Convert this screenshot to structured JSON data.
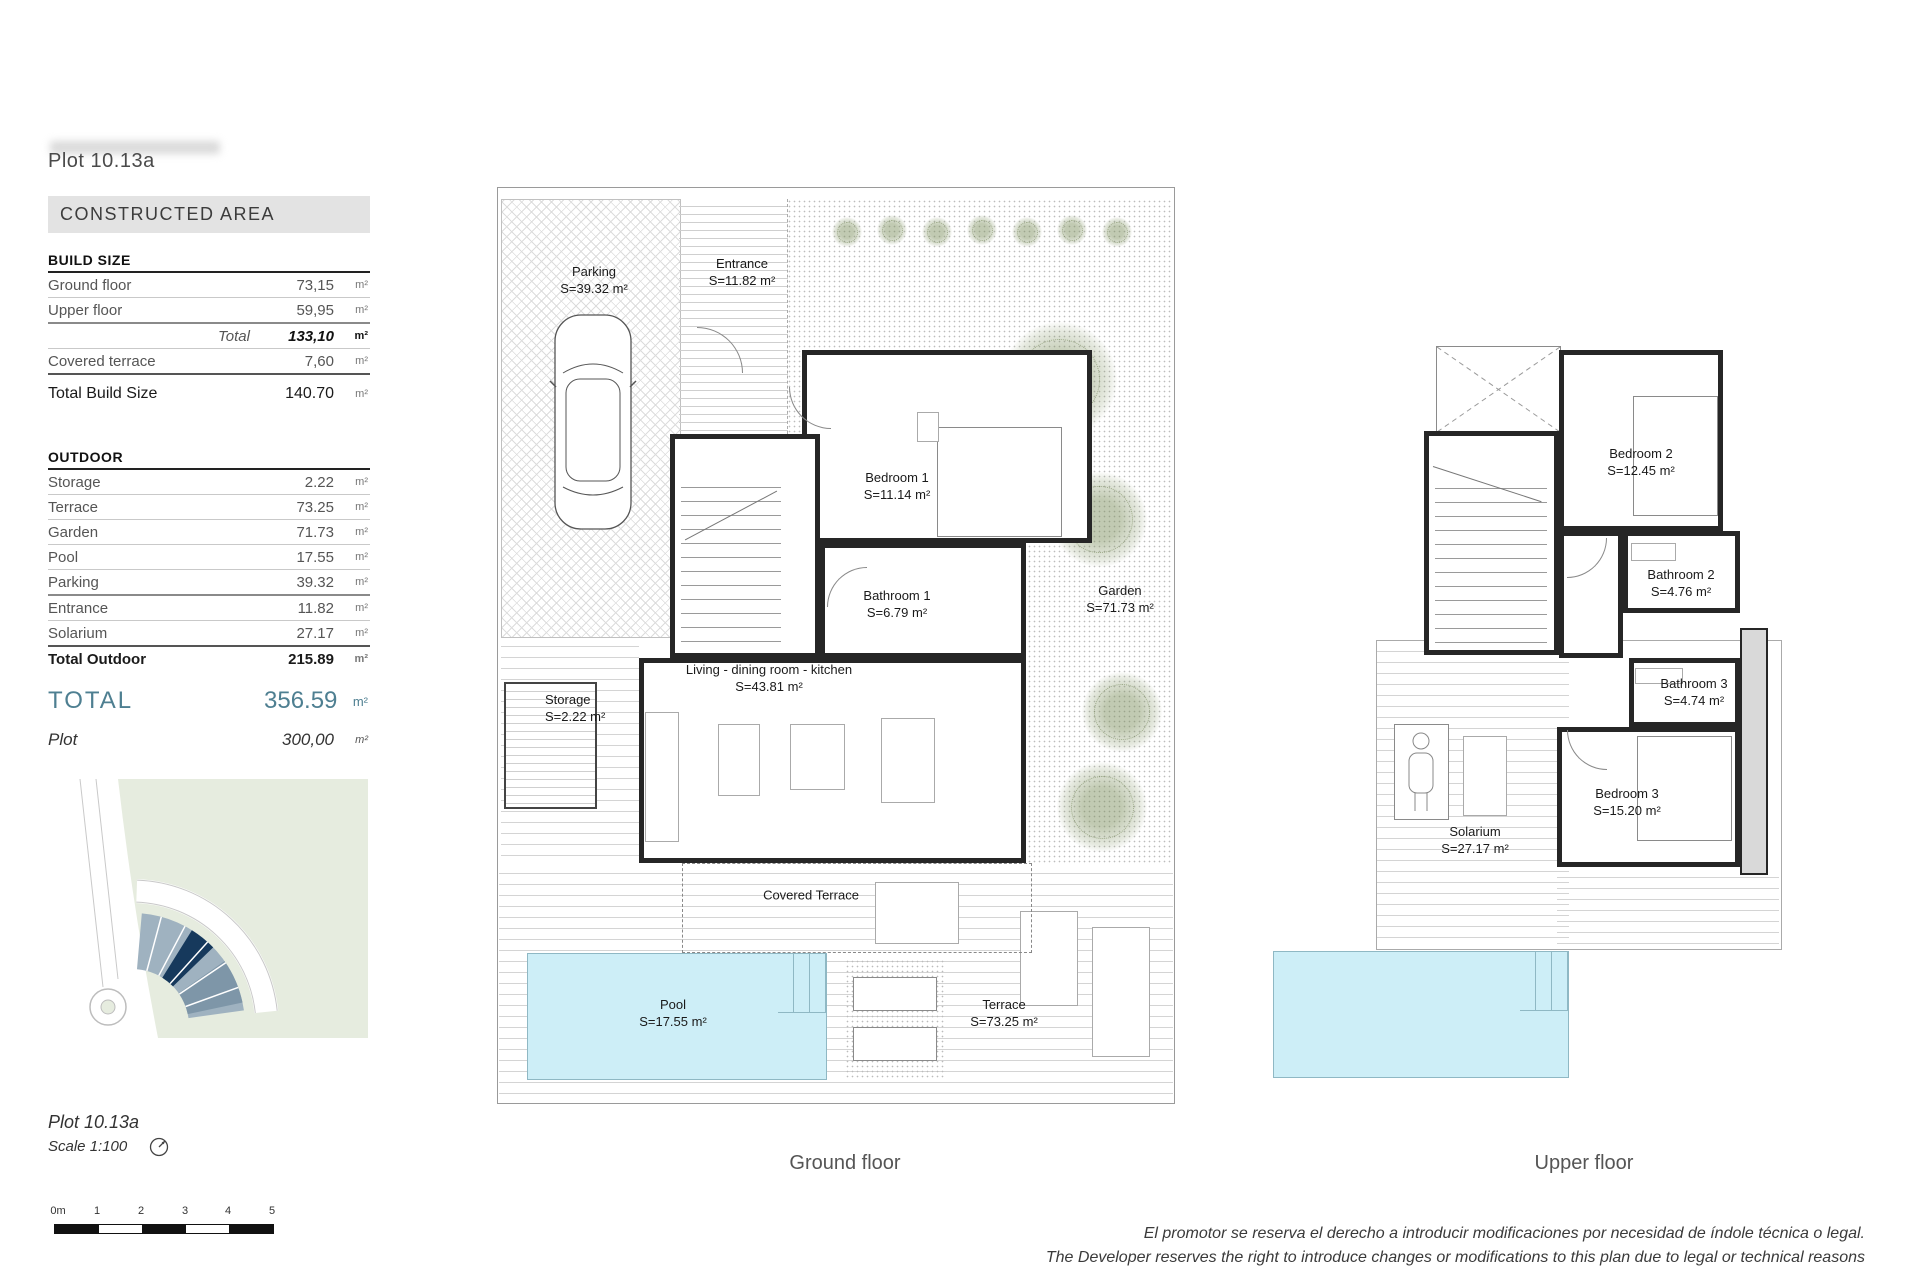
{
  "header": {
    "plot_title": "Plot 10.13a",
    "section_header": "CONSTRUCTED AREA"
  },
  "build_size": {
    "header": "BUILD SIZE",
    "rows": [
      {
        "label": "Ground floor",
        "value": "73,15",
        "unit": "m²"
      },
      {
        "label": "Upper floor",
        "value": "59,95",
        "unit": "m²"
      },
      {
        "label": "Total",
        "value": "133,10",
        "unit": "m²"
      },
      {
        "label": "Covered terrace",
        "value": "7,60",
        "unit": "m²"
      },
      {
        "label": "Total Build Size",
        "value": "140.70",
        "unit": "m²"
      }
    ]
  },
  "outdoor": {
    "header": "OUTDOOR",
    "rows": [
      {
        "label": "Storage",
        "value": "2.22",
        "unit": "m²"
      },
      {
        "label": "Terrace",
        "value": "73.25",
        "unit": "m²"
      },
      {
        "label": "Garden",
        "value": "71.73",
        "unit": "m²"
      },
      {
        "label": "Pool",
        "value": "17.55",
        "unit": "m²"
      },
      {
        "label": "Parking",
        "value": "39.32",
        "unit": "m²"
      },
      {
        "label": "Entrance",
        "value": "11.82",
        "unit": "m²"
      },
      {
        "label": "Solarium",
        "value": "27.17",
        "unit": "m²"
      },
      {
        "label": "Total Outdoor",
        "value": "215.89",
        "unit": "m²"
      }
    ]
  },
  "totals": {
    "total_label": "TOTAL",
    "total_value": "356.59",
    "total_unit": "m²",
    "plot_label": "Plot",
    "plot_value": "300,00",
    "plot_unit": "m²"
  },
  "footer_left": {
    "plot_title": "Plot 10.13a",
    "scale": "Scale 1:100"
  },
  "scalebar": {
    "labels": [
      "0m",
      "1",
      "2",
      "3",
      "4",
      "5"
    ]
  },
  "ground_floor": {
    "caption": "Ground floor",
    "rooms": {
      "parking": {
        "name": "Parking",
        "area": "S=39.32 m²"
      },
      "entrance": {
        "name": "Entrance",
        "area": "S=11.82 m²"
      },
      "bedroom1": {
        "name": "Bedroom 1",
        "area": "S=11.14 m²"
      },
      "bathroom1": {
        "name": "Bathroom 1",
        "area": "S=6.79 m²"
      },
      "living": {
        "name": "Living - dining  room - kitchen",
        "area": "S=43.81 m²"
      },
      "garden": {
        "name": "Garden",
        "area": "S=71.73 m²"
      },
      "storage": {
        "name": "Storage",
        "area": "S=2.22 m²"
      },
      "covered_terrace": {
        "name": "Covered Terrace"
      },
      "pool": {
        "name": "Pool",
        "area": "S=17.55 m²"
      },
      "terrace": {
        "name": "Terrace",
        "area": "S=73.25 m²"
      }
    }
  },
  "upper_floor": {
    "caption": "Upper floor",
    "rooms": {
      "bedroom2": {
        "name": "Bedroom 2",
        "area": "S=12.45 m²"
      },
      "bathroom2": {
        "name": "Bathroom 2",
        "area": "S=4.76 m²"
      },
      "bathroom3": {
        "name": "Bathroom 3",
        "area": "S=4.74 m²"
      },
      "bedroom3": {
        "name": "Bedroom 3",
        "area": "S=15.20 m²"
      },
      "solarium": {
        "name": "Solarium",
        "area": "S=27.17 m²"
      }
    }
  },
  "disclaimer": {
    "line1": "El promotor se reserva el derecho a introducir modificaciones por necesidad de índole técnica o legal.",
    "line2": "The Developer reserves the right to introduce changes or modifications to this plan due to legal or technical reasons"
  },
  "colors": {
    "accent_teal": "#4e7f91",
    "pool_blue": "#cdeef7",
    "map_green": "#e6ecdf",
    "map_plot_light": "#9fb2c0",
    "map_plot_mid": "#7e96a8",
    "map_plot_highlight": "#16395c"
  }
}
